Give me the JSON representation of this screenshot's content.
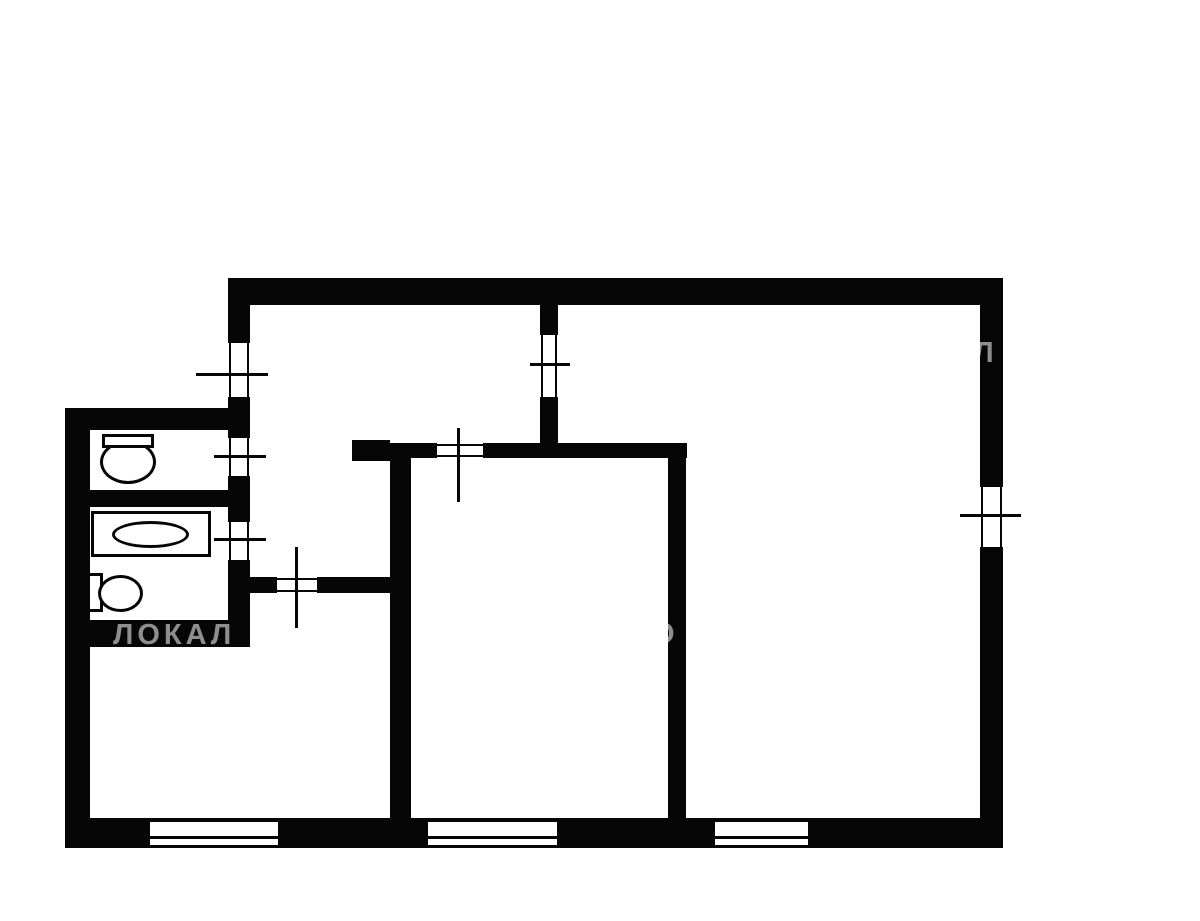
{
  "diagram_type": "apartment-floor-plan",
  "background_color": "#ffffff",
  "wall_color": "#060606",
  "watermark": {
    "color": "rgba(255,255,255,0.55)",
    "pieces": [
      {
        "text": "ЛОКАЛ",
        "x": 113,
        "y": 621,
        "size": 29
      },
      {
        "text": "О",
        "x": 652,
        "y": 620,
        "size": 29
      },
      {
        "text": "АЛ",
        "x": 948,
        "y": 339,
        "size": 29
      }
    ]
  },
  "plan": {
    "walls": [
      {
        "name": "top-wall",
        "x": 228,
        "y": 278,
        "w": 775,
        "h": 27
      },
      {
        "name": "right-wall",
        "x": 980,
        "y": 278,
        "w": 23,
        "h": 570
      },
      {
        "name": "bottom-wall",
        "x": 65,
        "y": 818,
        "w": 938,
        "h": 30
      },
      {
        "name": "left-upper-wall",
        "x": 228,
        "y": 278,
        "w": 22,
        "h": 152
      },
      {
        "name": "utility-top-wall",
        "x": 65,
        "y": 408,
        "w": 185,
        "h": 22
      },
      {
        "name": "left-outer-wall",
        "x": 65,
        "y": 408,
        "w": 25,
        "h": 440
      },
      {
        "name": "hall-west-wall",
        "x": 228,
        "y": 430,
        "w": 22,
        "h": 217
      },
      {
        "name": "wc-bath-divider",
        "x": 83,
        "y": 490,
        "w": 147,
        "h": 17
      },
      {
        "name": "utility-bottom-wall",
        "x": 65,
        "y": 620,
        "w": 185,
        "h": 27
      },
      {
        "name": "room-divider-wall",
        "x": 540,
        "y": 305,
        "w": 18,
        "h": 153
      },
      {
        "name": "kitchen-top-wall",
        "x": 352,
        "y": 443,
        "w": 335,
        "h": 15
      },
      {
        "name": "kitchen-top-stub",
        "x": 352,
        "y": 440,
        "w": 38,
        "h": 21
      },
      {
        "name": "kitchen-west-wall",
        "x": 390,
        "y": 450,
        "w": 21,
        "h": 398
      },
      {
        "name": "hall-south-wall",
        "x": 245,
        "y": 577,
        "w": 150,
        "h": 16
      },
      {
        "name": "kitchen-east-wall",
        "x": 668,
        "y": 455,
        "w": 18,
        "h": 365
      }
    ],
    "tick_windows": [
      {
        "name": "left-room-window",
        "orient": "v",
        "x": 228,
        "y": 343,
        "w": 22,
        "h": 54,
        "tick": {
          "x": 196,
          "y": 373,
          "w": 72,
          "h": 3
        }
      },
      {
        "name": "divider-opening",
        "orient": "v",
        "x": 540,
        "y": 335,
        "w": 18,
        "h": 62,
        "tick": {
          "x": 530,
          "y": 363,
          "w": 40,
          "h": 3
        }
      },
      {
        "name": "wc-door",
        "orient": "v",
        "x": 228,
        "y": 438,
        "w": 22,
        "h": 38,
        "tick": {
          "x": 214,
          "y": 455,
          "w": 52,
          "h": 3
        }
      },
      {
        "name": "bathroom-door",
        "orient": "v",
        "x": 228,
        "y": 522,
        "w": 22,
        "h": 38,
        "tick": {
          "x": 214,
          "y": 538,
          "w": 52,
          "h": 3
        }
      },
      {
        "name": "right-room-window",
        "orient": "v",
        "x": 980,
        "y": 487,
        "w": 23,
        "h": 60,
        "tick": {
          "x": 960,
          "y": 514,
          "w": 61,
          "h": 3
        }
      },
      {
        "name": "kitchen-top-opening",
        "orient": "h",
        "x": 437,
        "y": 443,
        "w": 46,
        "h": 15,
        "tick": {
          "x": 457,
          "y": 428,
          "w": 3,
          "h": 74
        }
      },
      {
        "name": "hall-south-door",
        "orient": "h",
        "x": 277,
        "y": 577,
        "w": 40,
        "h": 16,
        "tick": {
          "x": 295,
          "y": 547,
          "w": 3,
          "h": 81
        }
      }
    ],
    "band_windows": [
      {
        "name": "bottom-window-left",
        "x": 150,
        "y": 822,
        "w": 128,
        "h": 26
      },
      {
        "name": "bottom-window-middle",
        "x": 428,
        "y": 822,
        "w": 129,
        "h": 26
      },
      {
        "name": "bottom-window-right",
        "x": 715,
        "y": 822,
        "w": 93,
        "h": 26
      }
    ],
    "fixtures": [
      {
        "name": "toilet-bowl",
        "shape": "ellipse",
        "x": 100,
        "y": 440,
        "w": 56,
        "h": 44
      },
      {
        "name": "toilet-tank",
        "shape": "rect",
        "x": 102,
        "y": 434,
        "w": 52,
        "h": 14
      },
      {
        "name": "bathtub",
        "shape": "rect",
        "x": 91,
        "y": 511,
        "w": 120,
        "h": 46
      },
      {
        "name": "bathtub-basin",
        "shape": "ellipse",
        "x": 112,
        "y": 521,
        "w": 77,
        "h": 27
      },
      {
        "name": "toilet2-tank",
        "shape": "rect",
        "x": 87,
        "y": 573,
        "w": 16,
        "h": 39
      },
      {
        "name": "toilet2-bowl",
        "shape": "ellipse",
        "x": 98,
        "y": 575,
        "w": 45,
        "h": 37
      }
    ]
  }
}
